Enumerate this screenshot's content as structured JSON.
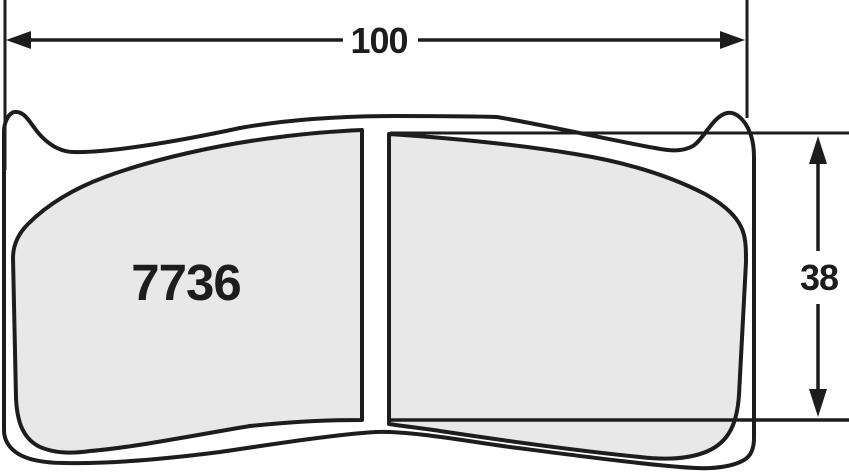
{
  "drawing": {
    "title": "brake-pad-dimensional-drawing",
    "part_number": "7736",
    "width_dimension": "100",
    "height_dimension": "38",
    "colors": {
      "line": "#1d1d1d",
      "friction_material": "#e8e8e8",
      "background": "#ffffff"
    }
  }
}
